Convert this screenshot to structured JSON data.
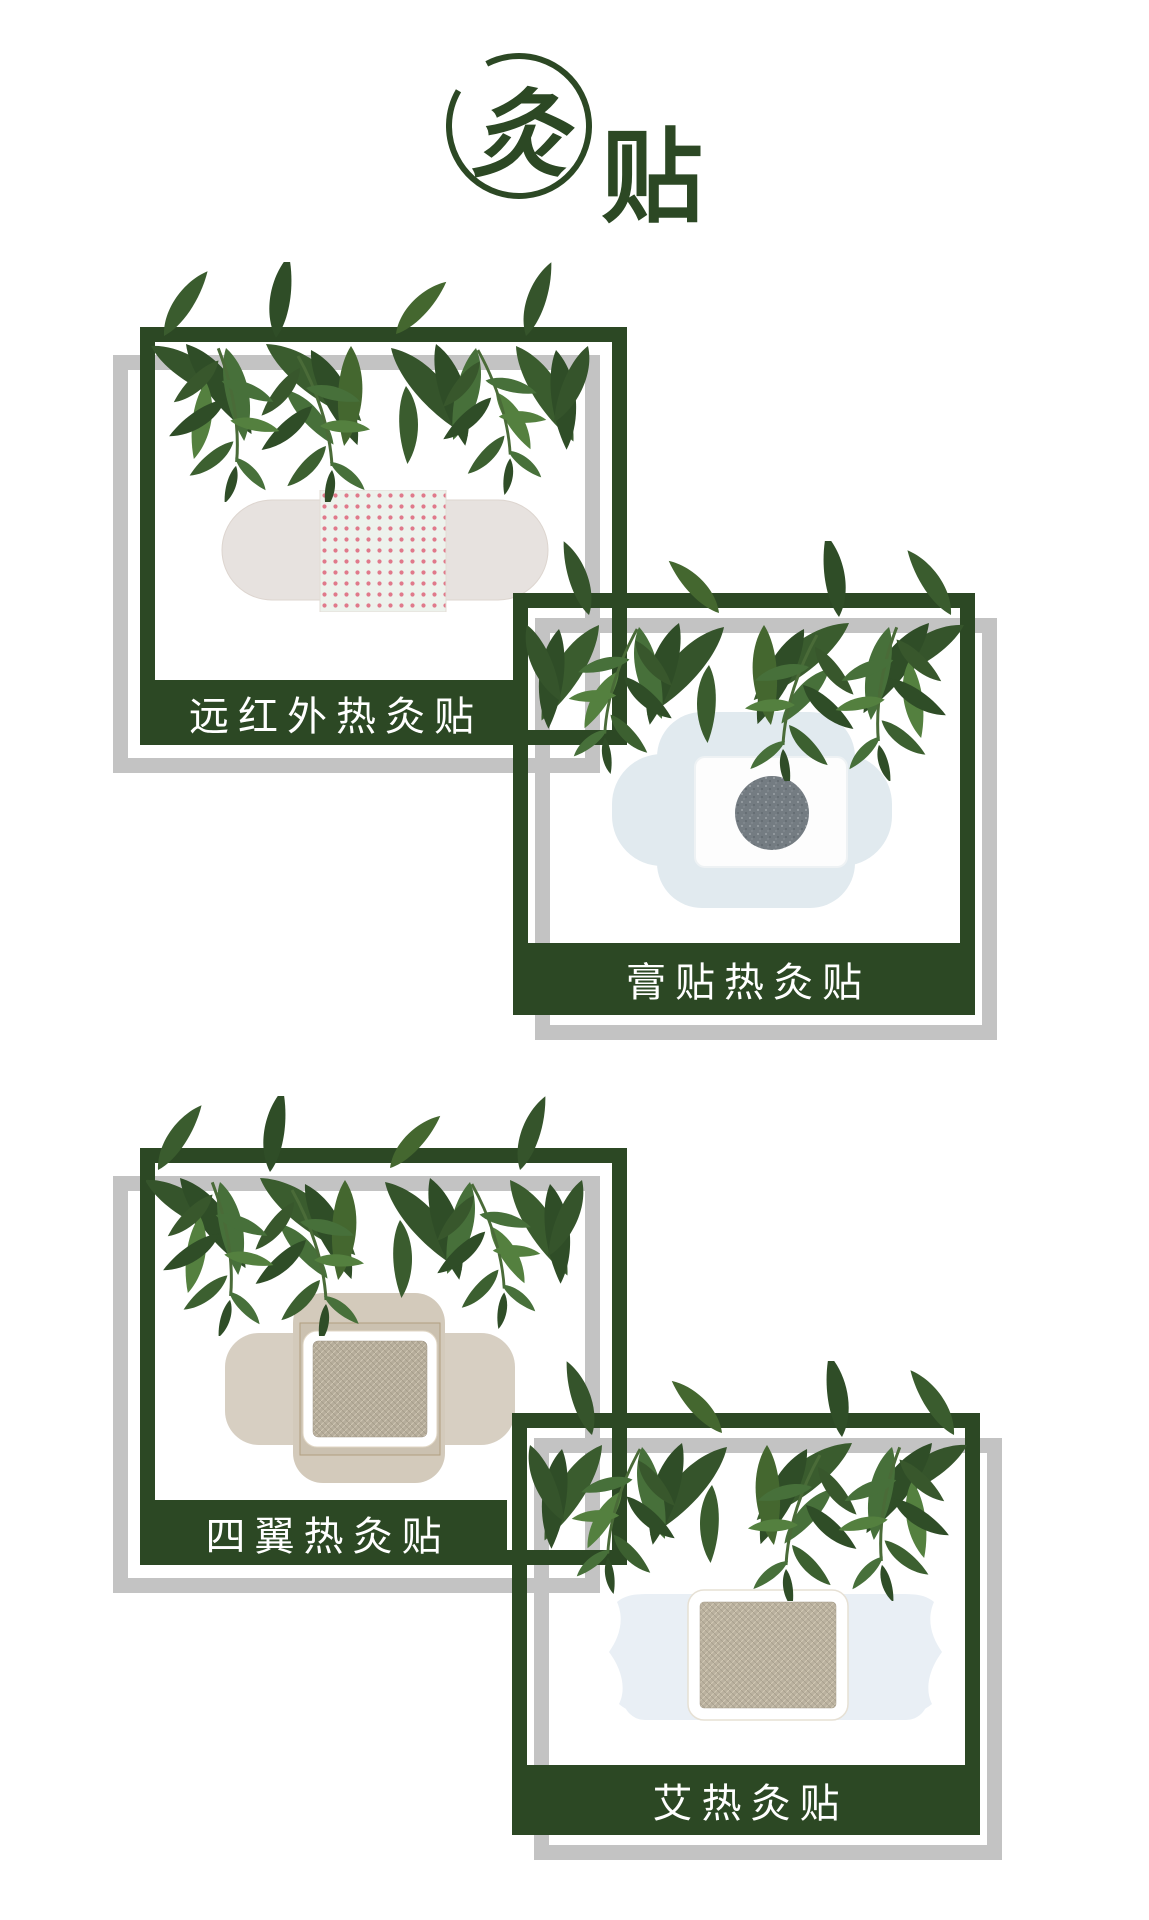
{
  "page": {
    "width": 1149,
    "height": 1920,
    "background": "#ffffff"
  },
  "logo": {
    "main_char": "灸",
    "sub_char": "贴"
  },
  "colors": {
    "frame_green": "#2c4824",
    "frame_gray": "#c3c3c3",
    "label_text": "#ffffff",
    "leaf_greens": [
      "#2f4d27",
      "#3a5c2e",
      "#47703a",
      "#54803f"
    ],
    "patch1_dot_pink": "#e0798b",
    "patch2_blue": "#e1eaef",
    "patch2_disc_gray": "#747c82",
    "patch3_tan": "#d7cfc2",
    "patch_pad_khaki": "#b6ad9b"
  },
  "cards": [
    {
      "id": "far-infrared",
      "label": "远红外热灸贴",
      "patch": "band-aid patch with pink dotted center"
    },
    {
      "id": "plaster",
      "label": "膏贴热灸贴",
      "patch": "four-lobed patch with gray herbal disc"
    },
    {
      "id": "four-wing",
      "label": "四翼热灸贴",
      "patch": "four-wing tan patch with khaki pad"
    },
    {
      "id": "moxa",
      "label": "艾热灸贴",
      "patch": "winged blue patch with khaki moxa pad"
    }
  ]
}
